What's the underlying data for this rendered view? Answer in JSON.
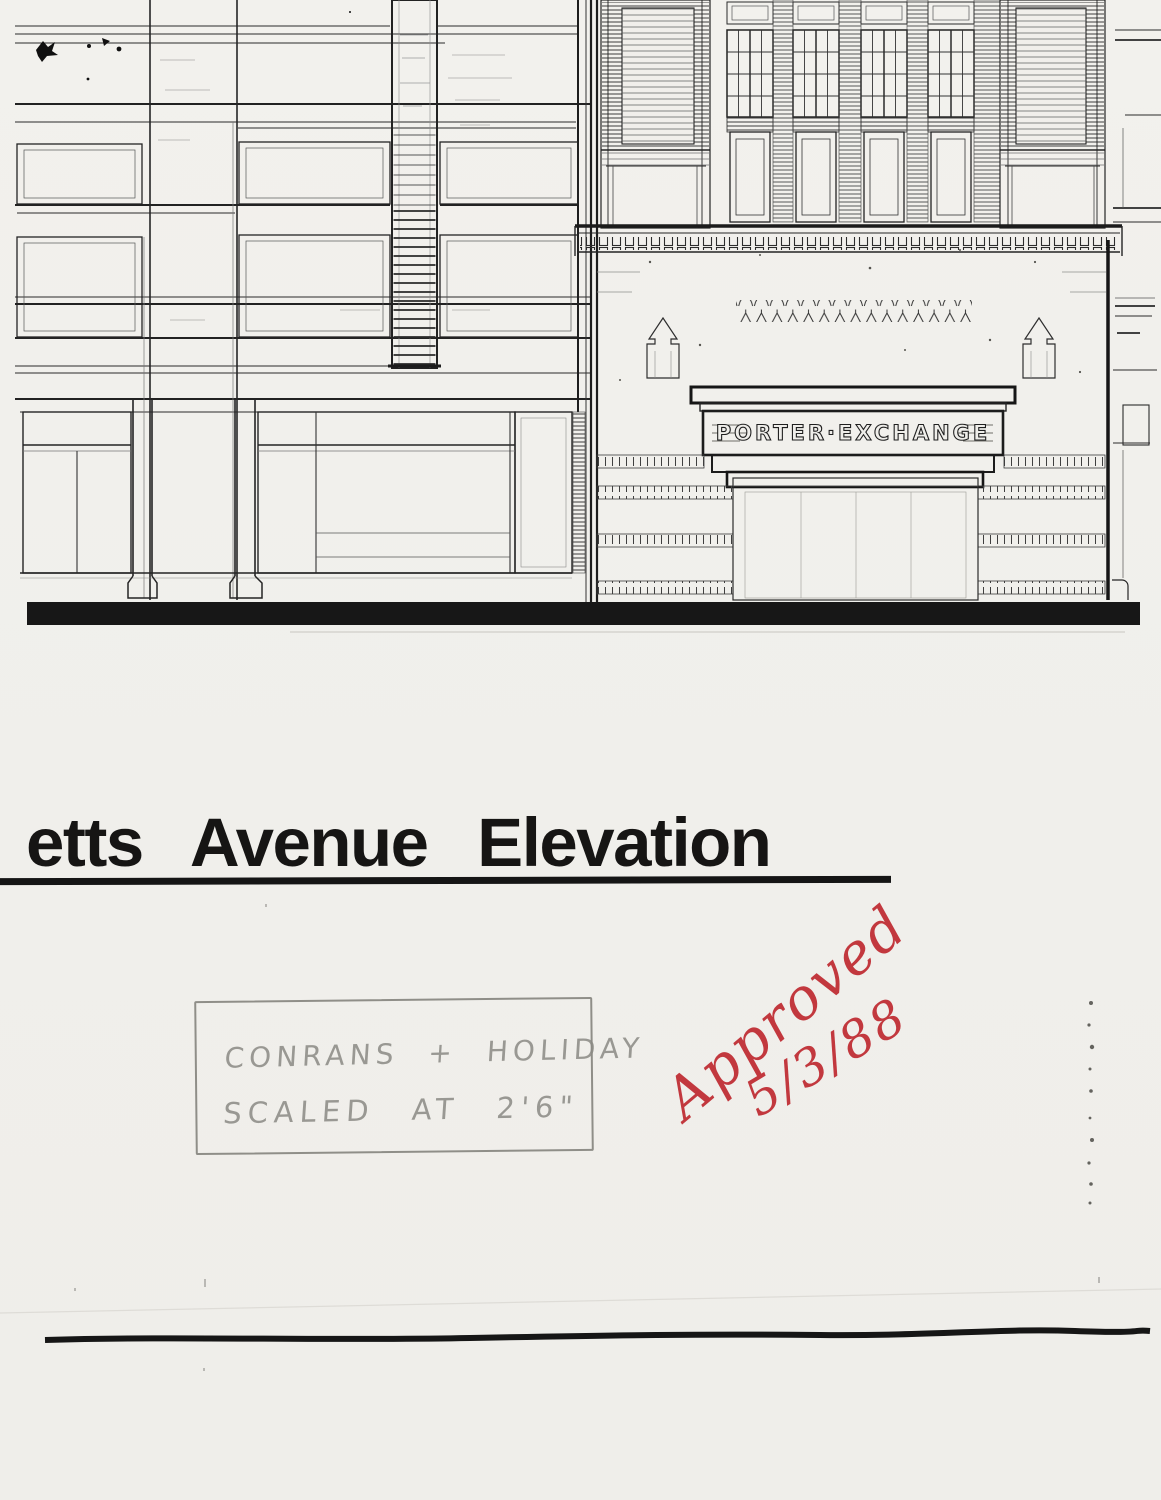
{
  "page": {
    "paper_color": "#f1efeb",
    "ink_color": "#1b1b1b"
  },
  "title": {
    "text": "etts Avenue Elevation"
  },
  "drawing": {
    "sign_text": "PORTER·EXCHANGE"
  },
  "note_box": {
    "line1": "CONRANS + HOLIDAY",
    "line2": "SCALED AT 2'6\""
  },
  "approval": {
    "word": "Approved",
    "date": "5/3/88",
    "ink_color": "#c2383e"
  }
}
